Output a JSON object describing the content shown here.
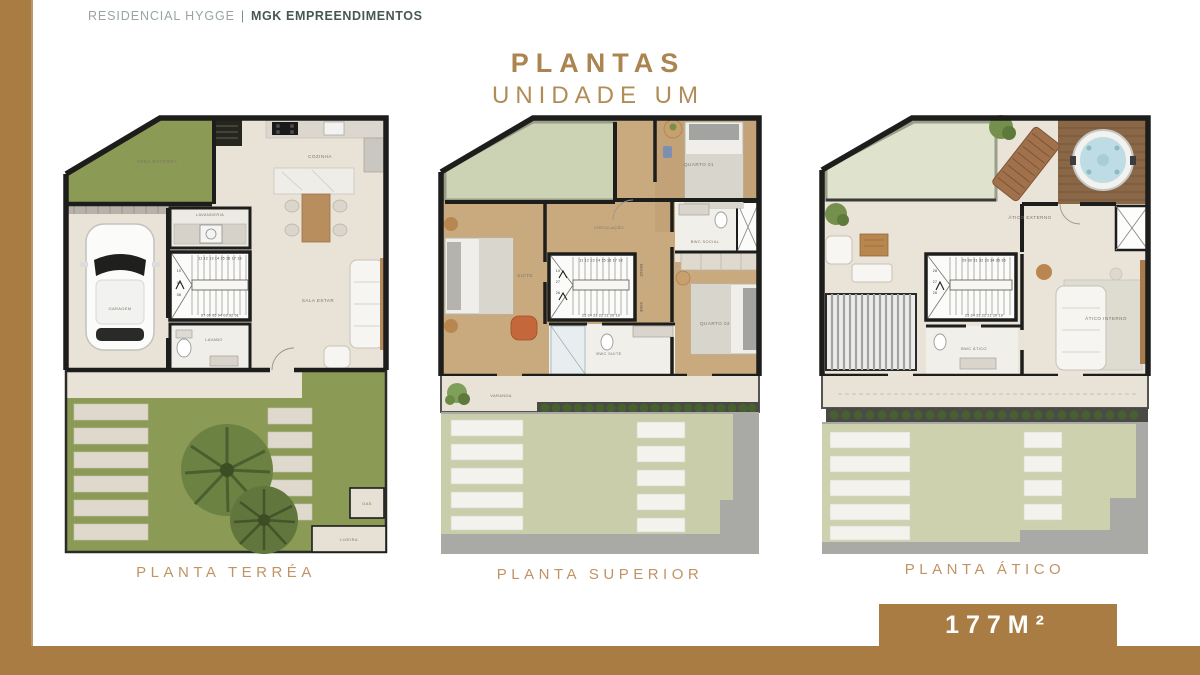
{
  "header": {
    "brand": "RESIDENCIAL HYGGE",
    "divider": "|",
    "company": "MGK EMPREENDIMENTOS"
  },
  "title": {
    "line1": "PLANTAS",
    "line2": "UNIDADE UM"
  },
  "badge": {
    "area": "177M²"
  },
  "colors": {
    "accent_brown": "#a87c43",
    "title_gold": "#ab8450",
    "caption_gold": "#c09463",
    "grass_green": "#8b9a55",
    "pale_roof_green": "#ccd3b5",
    "wood_floor": "#c9a97e",
    "deck_wood": "#8a6746",
    "floor_beige": "#e8e2d7",
    "wall_black": "#1d1d1b",
    "sidewalk_gray": "#a9a9a5"
  },
  "plans": [
    {
      "caption": "PLANTA TERRÉA",
      "rooms": {
        "area_externa": "AREA EXTERNA",
        "cozinha": "COZINHA",
        "lavanderia": "LAVANDERIA",
        "garagem": "GARAGEM",
        "sala_estar": "SALA ESTAR",
        "lavabo": "LAVABO",
        "gas": "GAS",
        "lixeira": "LIXEIRA"
      },
      "stairs": {
        "top": "11 12 13 14 15 16 17 18",
        "left": [
          "10",
          "09",
          "08"
        ],
        "bottom": "07 06 05 04 03 02 01"
      }
    },
    {
      "caption": "PLANTA SUPERIOR",
      "rooms": {
        "quarto_01": "QUARTO 01",
        "circulacao": "CIRCULAÇÃO",
        "bwc_social": "BWC SOCIAL",
        "suite": "SUITE",
        "quarto_02": "QUARTO 02",
        "bwc_suite": "BWC SUITE",
        "varanda": "VARANDA"
      },
      "stairs": {
        "top": "11 12 13 14 15 16 17 18",
        "left": [
          "10",
          "27",
          "26"
        ],
        "bottom": "25 24 23 22 21 20 19",
        "desce": "DESCE",
        "sobe": "SOBE"
      }
    },
    {
      "caption": "PLANTA ÁTICO",
      "rooms": {
        "atico_externo": "ÁTICO EXTERNO",
        "atico_interno": "ÁTICO INTERNO",
        "bwc_atico": "BWC ÁTICO"
      },
      "stairs": {
        "top": "29 30 31 32 33 34 35 36",
        "left": [
          "28",
          "27",
          "26"
        ],
        "bottom": "25 24 23 22 21 20 19",
        "desce": "DESCE"
      }
    }
  ]
}
